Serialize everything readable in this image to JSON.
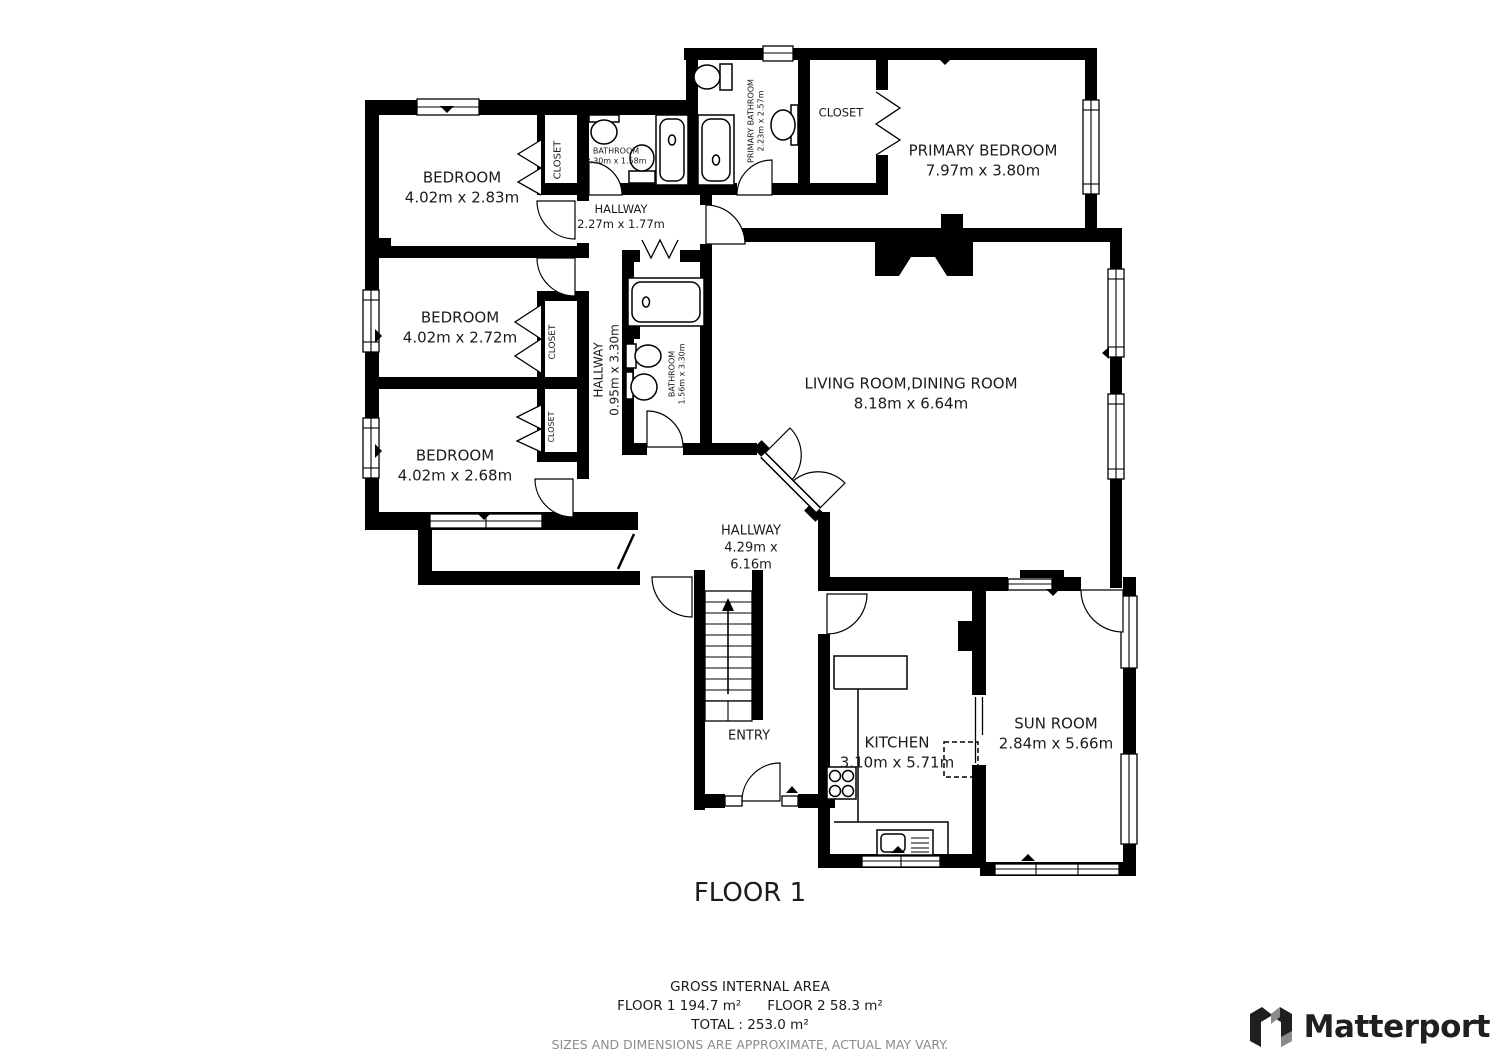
{
  "floor": {
    "title": "FLOOR 1"
  },
  "rooms": {
    "bedroom1": {
      "name": "BEDROOM",
      "dims": "4.02m x 2.83m"
    },
    "bedroom2": {
      "name": "BEDROOM",
      "dims": "4.02m x 2.72m"
    },
    "bedroom3": {
      "name": "BEDROOM",
      "dims": "4.02m x 2.68m"
    },
    "primary_bedroom": {
      "name": "PRIMARY BEDROOM",
      "dims": "7.97m x 3.80m"
    },
    "living": {
      "name": "LIVING ROOM,DINING ROOM",
      "dims": "8.18m x 6.64m"
    },
    "kitchen": {
      "name": "KITCHEN",
      "dims": "3.10m x 5.71m"
    },
    "sunroom": {
      "name": "SUN ROOM",
      "dims": "2.84m x 5.66m"
    },
    "hallway_top": {
      "name": "HALLWAY",
      "dims": "2.27m x 1.77m"
    },
    "hallway_mid": {
      "name": "HALLWAY",
      "dims": "0.95m x 3.30m"
    },
    "hallway_main": {
      "name": "HALLWAY",
      "dims": "4.29m x 6.16m"
    },
    "entry": {
      "name": "ENTRY"
    },
    "bathroom_top": {
      "name": "BATHROOM",
      "dims": "2.30m x 1.58m"
    },
    "bathroom_mid": {
      "name": "BATHROOM",
      "dims": "1.56m x 3.30m"
    },
    "primary_bathroom": {
      "name": "PRIMARY BATHROOM",
      "dims": "2.23m x 2.57m"
    },
    "closet1": {
      "name": "CLOSET"
    },
    "closet2": {
      "name": "CLOSET"
    },
    "closet3": {
      "name": "CLOSET"
    },
    "closet_primary": {
      "name": "CLOSET"
    }
  },
  "footer": {
    "heading": "GROSS INTERNAL AREA",
    "floor1": "FLOOR 1 194.7 m²",
    "floor2": "FLOOR 2 58.3 m²",
    "total": "TOTAL :  253.0 m²",
    "disclaimer": "SIZES AND DIMENSIONS ARE APPROXIMATE, ACTUAL MAY VARY."
  },
  "brand": {
    "name": "Matterport"
  },
  "colors": {
    "wall": "#000000",
    "text": "#1b1b1b",
    "muted": "#8c8c8c"
  }
}
